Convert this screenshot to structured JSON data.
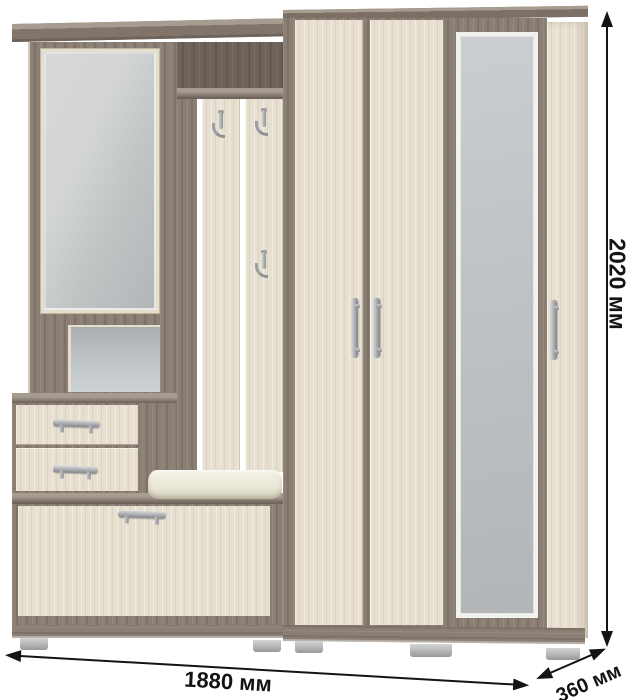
{
  "image": {
    "description": "Product render of a hallway wardrobe set with overall dimension arrows",
    "background": "#ffffff"
  },
  "dimensions": {
    "height_label": "2020 мм",
    "width_label": "1880 мм",
    "depth_label": "360 мм"
  },
  "furniture_icons": {
    "coat_hook": "double-prong metal coat hook",
    "handle_horizontal": "silver bar handle",
    "handle_vertical": "silver bar handle vertical"
  },
  "colors": {
    "wood-dark": "#8b7e74",
    "wood-dark-deep": "#6e635b",
    "wood-dark-top": "#a79c90",
    "wood-light": "#e7e0d1",
    "wood-light-deep": "#d8d0bd",
    "mirror-light": "#d3d5d6",
    "mirror-dark": "#b3b6b8",
    "bevel-cream": "#e5decc",
    "metal": "#a9abae",
    "metal-deep": "#83868a",
    "foot": "#b9bbbd",
    "cushion": "#ece8d8",
    "ink": "#141414",
    "bg": "#ffffff"
  }
}
